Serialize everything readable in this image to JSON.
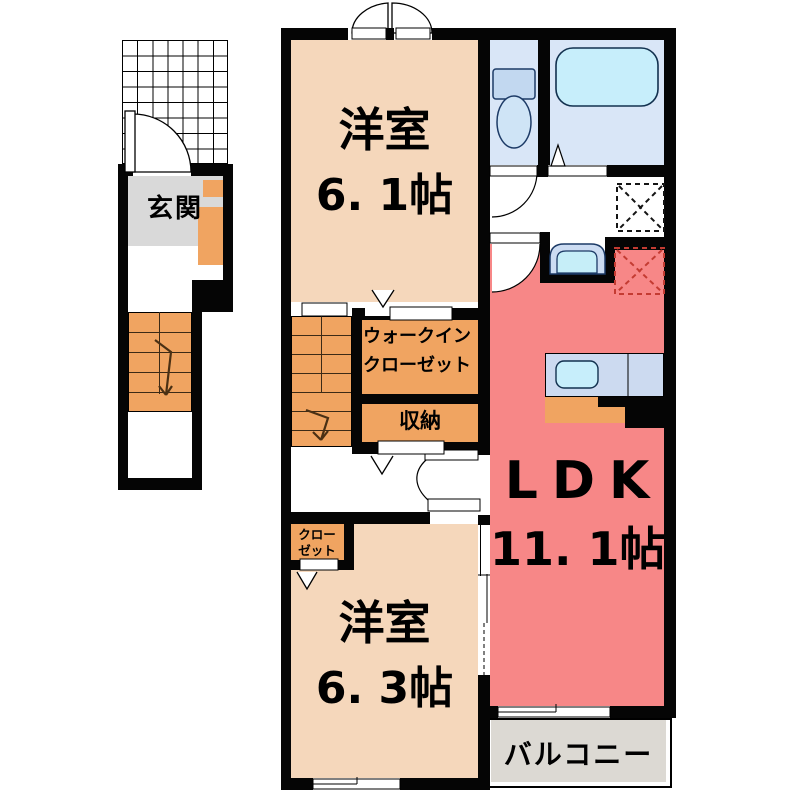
{
  "rooms": {
    "western_room_1": {
      "name": "洋室",
      "area": "6. 1帖"
    },
    "western_room_2": {
      "name": "洋室",
      "area": "6. 3帖"
    },
    "ldk": {
      "name": "LDK",
      "area": "11. 1帖"
    },
    "entrance": {
      "name": "玄関"
    },
    "walk_in_closet": {
      "line1": "ウォークイン",
      "line2": "クローゼット"
    },
    "storage": {
      "name": "収納"
    },
    "closet": {
      "line1": "クロー",
      "line2": "ゼット"
    },
    "balcony": {
      "name": "バルコニー"
    }
  },
  "fixtures": {
    "toilet": "toilet-icon",
    "bathtub": "bathtub-icon",
    "washbasin": "washbasin-icon",
    "kitchen_sink": "kitchen-sink-icon",
    "washer_space": "dashed-square-icon",
    "refrigerator_space": "dashed-square-icon",
    "staircase_main": "stairs-icon",
    "staircase_entry": "stairs-icon",
    "entrance_porch": "grid-icon"
  },
  "colors": {
    "wall": "#050505",
    "western_room": "#f5d7bb",
    "closet_orange": "#f0a461",
    "ldk_pink": "#f78787",
    "wet_area_blue": "#d9e6f7",
    "fixture_cyan": "#c7eefb",
    "entrance_gray": "#d9d9d9",
    "balcony_gray": "#dcd9d3",
    "appliance_dash_red": "#c43b32"
  }
}
